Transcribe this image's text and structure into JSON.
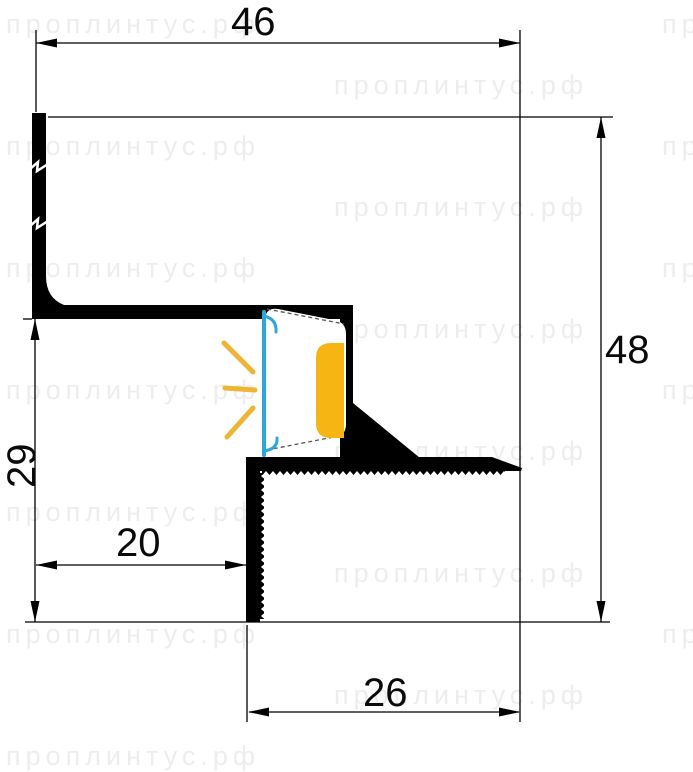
{
  "title": "Aluminium LED plinth profile cross-section drawing",
  "watermark": {
    "text": "проплинтус.рф",
    "color": "#ededed"
  },
  "dimensions": {
    "top_width": "46",
    "right_height": "48",
    "left_height": "29",
    "inner_width": "20",
    "bottom_width": "26"
  },
  "colors": {
    "profile": "#000000",
    "led_diffuser": "#2ba7dd",
    "led_glow": "#f7b513",
    "led_rays": "#eeb434",
    "dimension_lines": "#000000"
  }
}
